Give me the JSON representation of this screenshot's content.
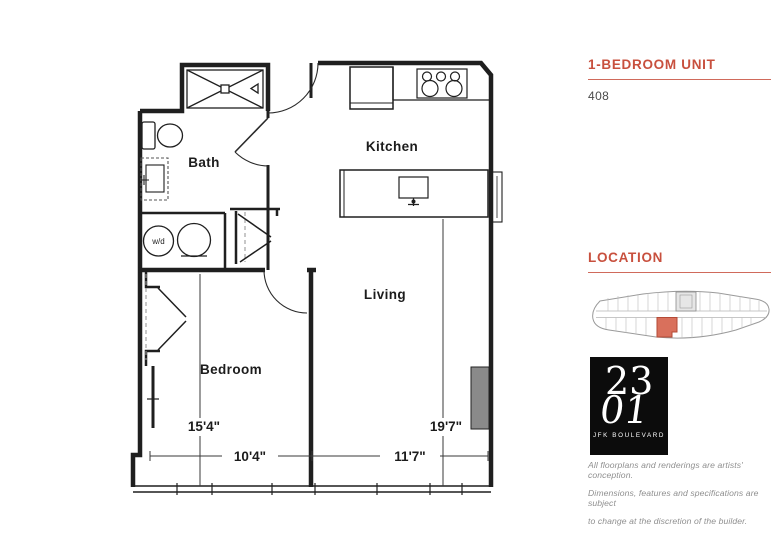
{
  "sidebar": {
    "accent_color": "#C8503E",
    "unit": {
      "heading": "1-BEDROOM UNIT",
      "number": "408"
    },
    "location": {
      "heading": "LOCATION",
      "highlight_color": "#D9705C"
    },
    "logo": {
      "top": "23",
      "bottom": "01",
      "street": "JFK BOULEVARD"
    },
    "disclaimer": {
      "line1": "All floorplans and renderings are artists' conception.",
      "line2": "Dimensions, features and specifications are subject",
      "line3": "to change at the discretion of the builder."
    }
  },
  "floorplan": {
    "rooms": {
      "bath": "Bath",
      "kitchen": "Kitchen",
      "living": "Living",
      "bedroom": "Bedroom"
    },
    "appliances": {
      "washer_dryer": "w/d"
    },
    "dimensions": {
      "bedroom_depth": "15'4\"",
      "bedroom_width": "10'4\"",
      "living_depth": "19'7\"",
      "living_width": "11'7\""
    }
  }
}
